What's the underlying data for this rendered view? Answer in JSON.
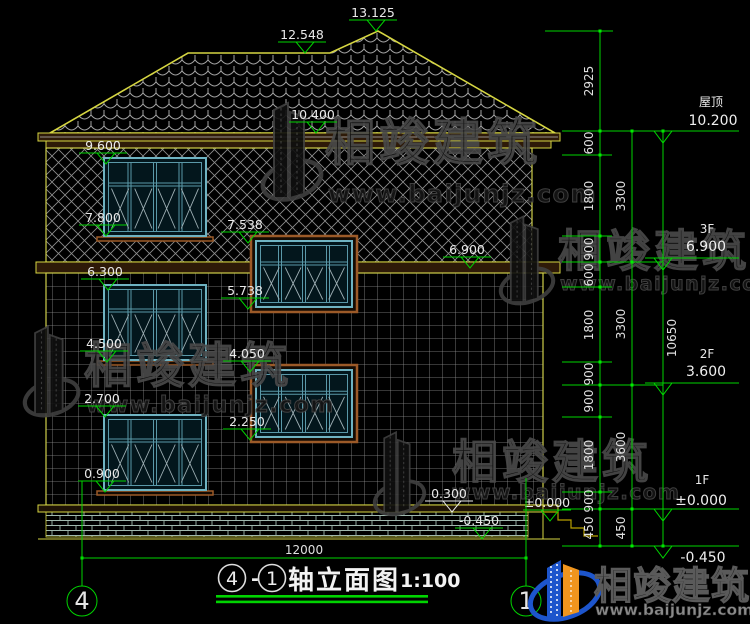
{
  "drawing": {
    "title_text": "轴立面图",
    "scale_note": "1:100",
    "axis_left": "4",
    "axis_right": "1",
    "title_axis_left": "4",
    "title_axis_right": "1",
    "dash": "-",
    "width_dim": "12000"
  },
  "marks": {
    "ridge_main": "13.125",
    "ridge_left": "12.548",
    "eave_upper": "10.400",
    "lv_9600": "9.600",
    "lv_7800": "7.800",
    "lv_7538": "7.538",
    "lv_6900": "6.900",
    "lv_6300": "6.300",
    "lv_5738": "5.738",
    "lv_4500": "4.500",
    "lv_4050": "4.050",
    "lv_2700": "2.700",
    "lv_2250": "2.250",
    "lv_0900": "0.900",
    "lv_0300": "0.300",
    "lv_zero": "±0.000",
    "lv_neg450": "-0.450"
  },
  "right_panel": {
    "roof_label": "屋顶",
    "roof_value": "10.200",
    "f3_label": "3F",
    "f3_value": "6.900",
    "f2_label": "2F",
    "f2_value": "3.600",
    "f1_label": "1F",
    "f1_value": "±0.000",
    "below_value": "-0.450",
    "chain1": [
      "2925",
      "600",
      "1800",
      "900",
      "600",
      "1800",
      "900",
      "900",
      "1800",
      "900",
      "450"
    ],
    "chain2": [
      "3300",
      "3300",
      "3600",
      "450"
    ],
    "total": "10650"
  },
  "watermark": {
    "brand": "相竣建筑",
    "url": "www.baijunjz.com"
  },
  "colors": {
    "dim_green": "#00d400",
    "outline_yellow": "#d6d642",
    "window_teal": "#6fb3c2",
    "sill_brown": "#9c5a28",
    "brand_blue": "#1d55cc",
    "brand_orange": "#f0951e"
  }
}
